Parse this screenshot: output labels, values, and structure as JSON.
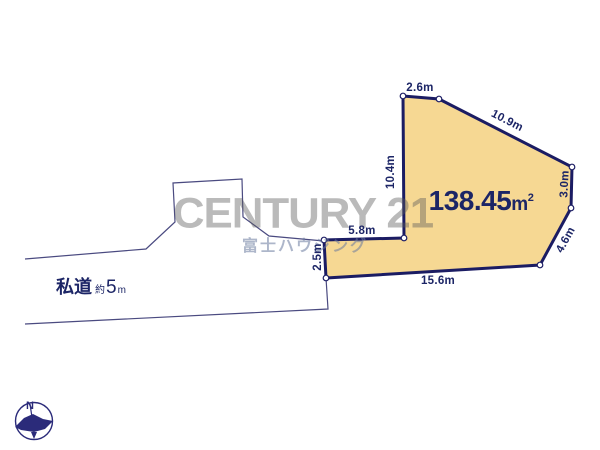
{
  "site_plan": {
    "area": {
      "value": "138.45",
      "unit_base": "m",
      "unit_exponent": "2"
    },
    "dimensions": [
      {
        "id": "top-edge",
        "value": "2.6m"
      },
      {
        "id": "upper-right-edge",
        "value": "10.9m"
      },
      {
        "id": "left-edge",
        "value": "10.4m"
      },
      {
        "id": "right-edge",
        "value": "3.0m"
      },
      {
        "id": "lower-right-edge",
        "value": "4.6m"
      },
      {
        "id": "bottom-edge",
        "value": "15.6m"
      },
      {
        "id": "notch-left-edge",
        "value": "2.5m"
      },
      {
        "id": "notch-top-edge",
        "value": "5.8m"
      }
    ],
    "road": {
      "name": "私道",
      "approx": "約",
      "width_value": "5",
      "width_unit": "m"
    },
    "compass": {
      "north_label": "N"
    }
  },
  "watermark": {
    "brand": "CENTURY 21",
    "subtitle": "富士ハウジング"
  },
  "colors": {
    "plot_fill": "#F6D893",
    "plot_border": "#1B1C63",
    "boundary_line": "#4A4A80",
    "dimension_text": "#1C2566",
    "watermark_gray": "#B3B3B3",
    "watermark_blue": "#9AA5BC",
    "background": "#FFFFFF"
  }
}
